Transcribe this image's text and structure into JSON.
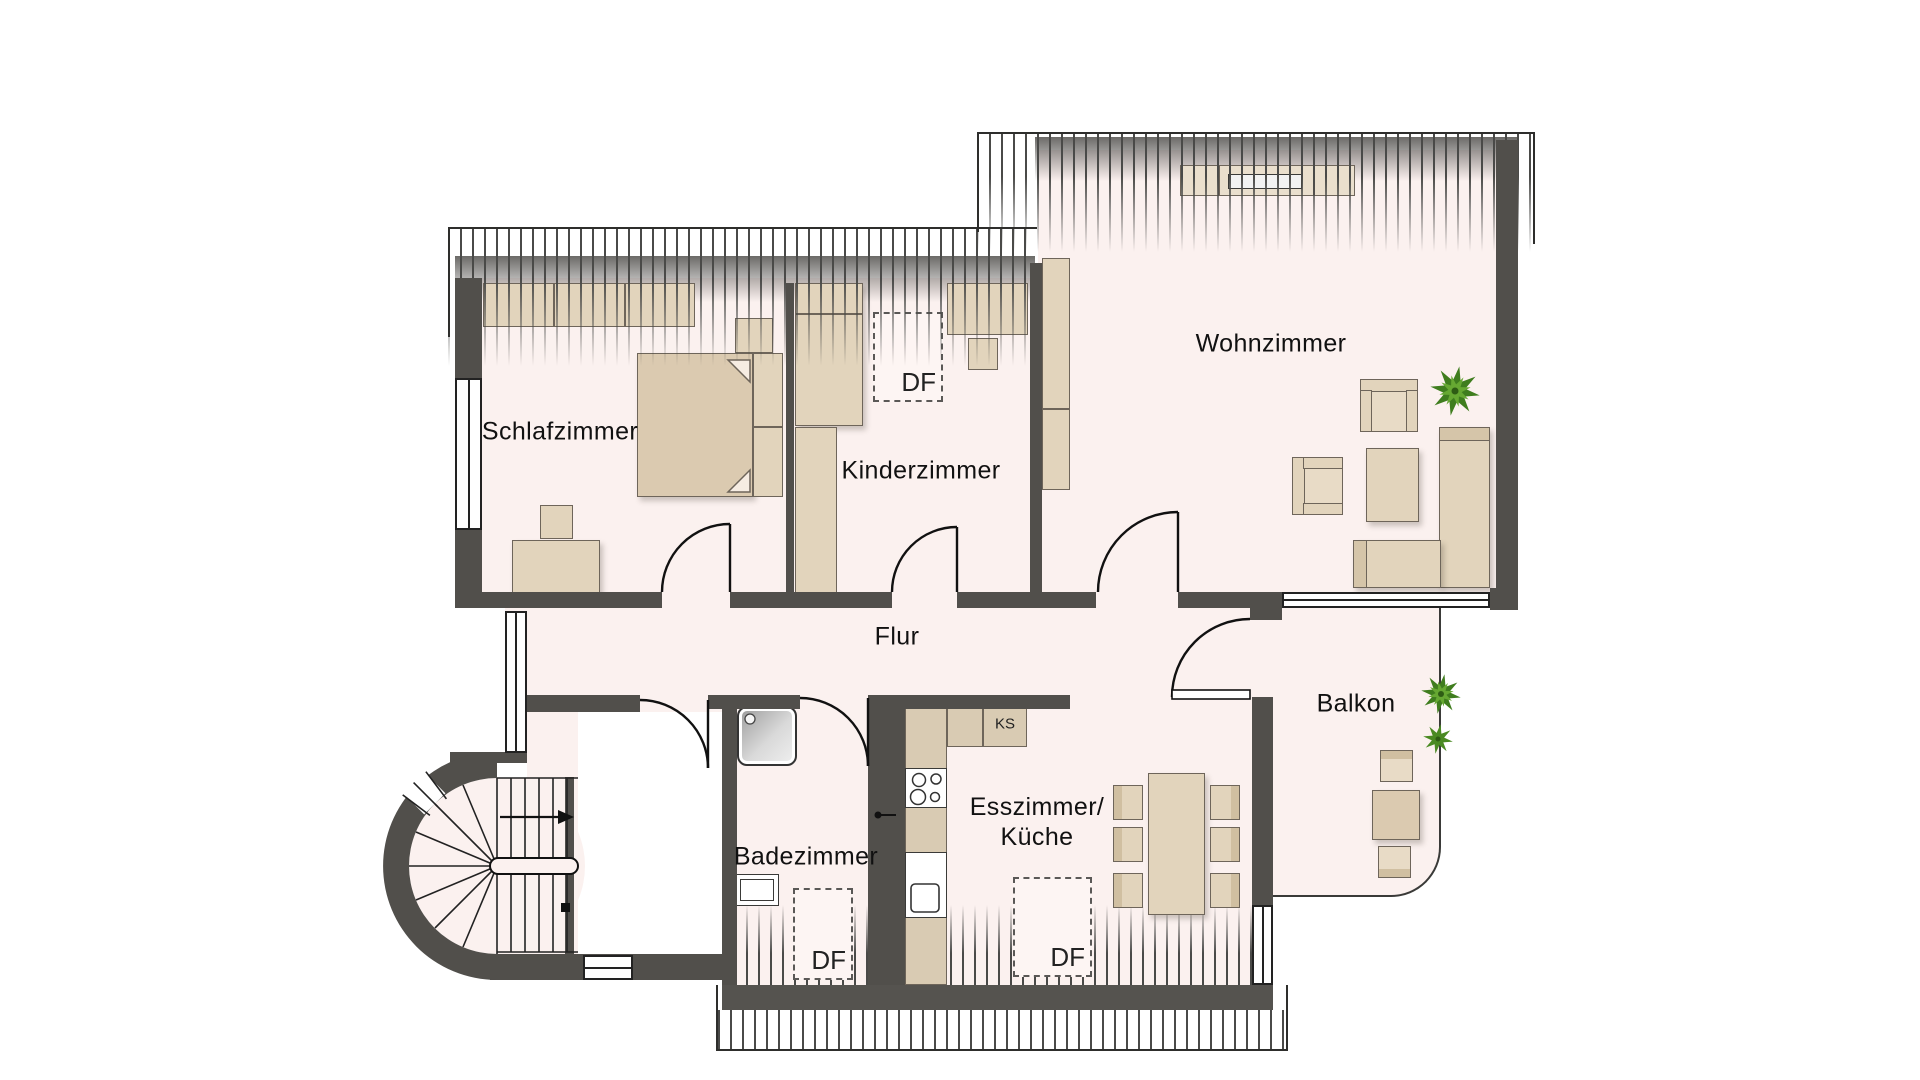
{
  "floorplan": {
    "rooms": [
      {
        "id": "schlafzimmer",
        "label": "Schlafzimmer"
      },
      {
        "id": "kinderzimmer",
        "label": "Kinderzimmer"
      },
      {
        "id": "wohnzimmer",
        "label": "Wohnzimmer"
      },
      {
        "id": "flur",
        "label": "Flur"
      },
      {
        "id": "badezimmer",
        "label": "Badezimmer"
      },
      {
        "id": "esszimmer_kueche",
        "label_line1": "Esszimmer/",
        "label_line2": "Küche"
      },
      {
        "id": "balkon",
        "label": "Balkon"
      }
    ],
    "annotations": {
      "roof_window_abbr": "DF",
      "fridge_abbr": "KS"
    },
    "colors": {
      "floor": "#fbf1ef",
      "wall": "#514f4b",
      "furniture": "#e2d4bc",
      "plant_dark": "#3f7d1e",
      "plant_light": "#66a832"
    }
  }
}
